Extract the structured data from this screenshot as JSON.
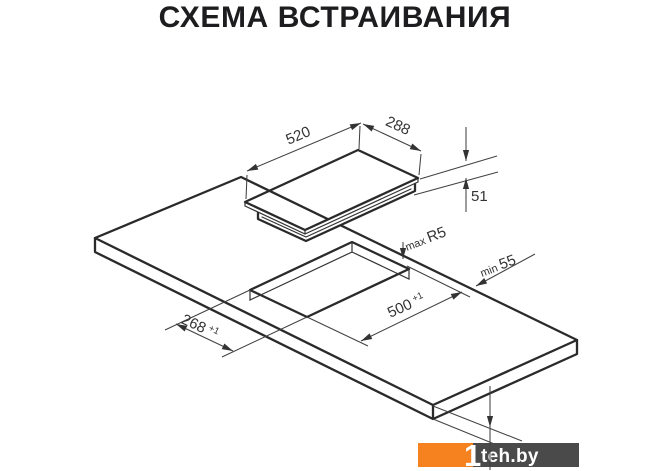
{
  "title": "СХЕМА ВСТРАИВАНИЯ",
  "diagram": {
    "hob": {
      "width_mm": "520",
      "depth_mm": "288",
      "height_mm": "51"
    },
    "cutout": {
      "width_mm": "500",
      "width_tol": "+1",
      "depth_mm": "268",
      "depth_tol": "+1",
      "corner_radius_label": "max",
      "corner_radius_value": "R5",
      "edge_clearance_label": "min",
      "edge_clearance_value": "55"
    }
  },
  "watermark": {
    "logo_glyph": "1",
    "site": "teh.by",
    "orange": "#F5821F",
    "gray": "#4A4A4A"
  }
}
